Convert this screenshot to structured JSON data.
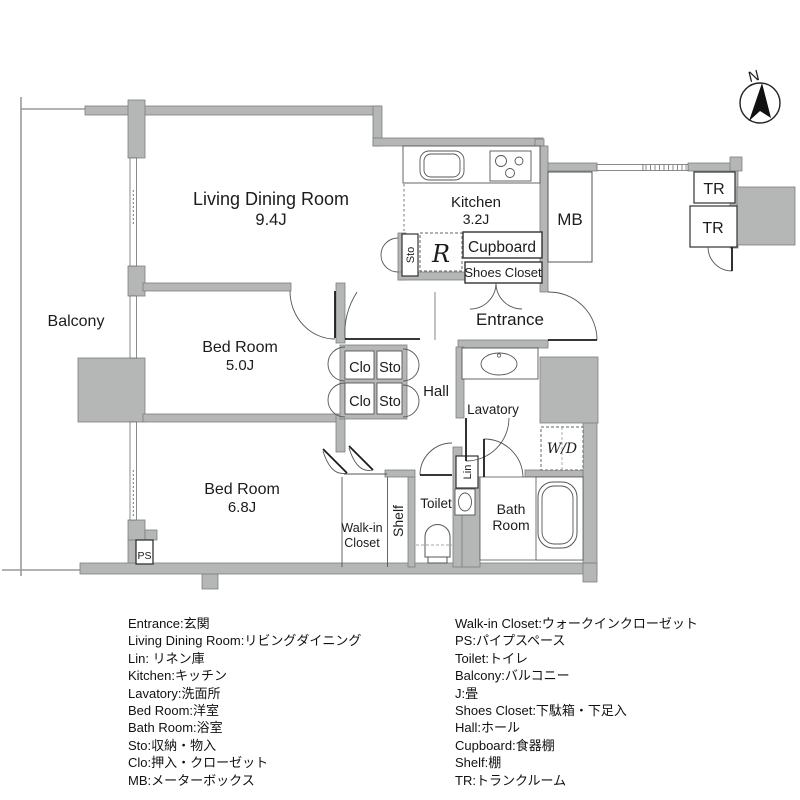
{
  "compass": {
    "north_label": "N"
  },
  "rooms": {
    "balcony": {
      "label": "Balcony"
    },
    "living_dining": {
      "label": "Living Dining Room",
      "size": "9.4J"
    },
    "kitchen": {
      "label": "Kitchen",
      "size": "3.2J"
    },
    "bedroom_5": {
      "label": "Bed Room",
      "size": "5.0J"
    },
    "bedroom_6": {
      "label": "Bed Room",
      "size": "6.8J"
    },
    "hall": {
      "label": "Hall"
    },
    "entrance": {
      "label": "Entrance"
    },
    "lavatory": {
      "label": "Lavatory"
    },
    "toilet": {
      "label": "Toilet"
    },
    "bath": {
      "line1": "Bath",
      "line2": "Room"
    },
    "walkin": {
      "line1": "Walk-in",
      "line2": "Closet"
    }
  },
  "closets": {
    "clo": "Clo",
    "sto": "Sto"
  },
  "fixtures": {
    "meter_box": "MB",
    "cupboard": "Cupboard",
    "shoes_closet": "Shoes Closet",
    "refrigerator": "R",
    "storage": "Sto",
    "washer_dryer": "W/D",
    "linen": "Lin",
    "shelf": "Shelf",
    "pipe_space": "PS",
    "trunk_room": "TR"
  },
  "legend": {
    "left": [
      "Entrance:玄関",
      "Living Dining Room:リビングダイニング",
      "Lin: リネン庫",
      "Kitchen:キッチン",
      "Lavatory:洗面所",
      "Bed Room:洋室",
      "Bath Room:浴室",
      "Sto:収納・物入",
      "Clo:押入・クローゼット",
      "MB:メーターボックス"
    ],
    "right": [
      "Walk-in Closet:ウォークインクローゼット",
      "PS:パイプスペース",
      "Toilet:トイレ",
      "Balcony:バルコニー",
      "J:畳",
      "Shoes Closet:下駄箱・下足入",
      "Hall:ホール",
      "Cupboard:食器棚",
      "Shelf:棚",
      "TR:トランクルーム"
    ]
  },
  "colors": {
    "wall_fill": "#b5b7b7",
    "wall_stroke": "#7d7f7f",
    "line": "#2f2f2f",
    "background": "#ffffff"
  }
}
